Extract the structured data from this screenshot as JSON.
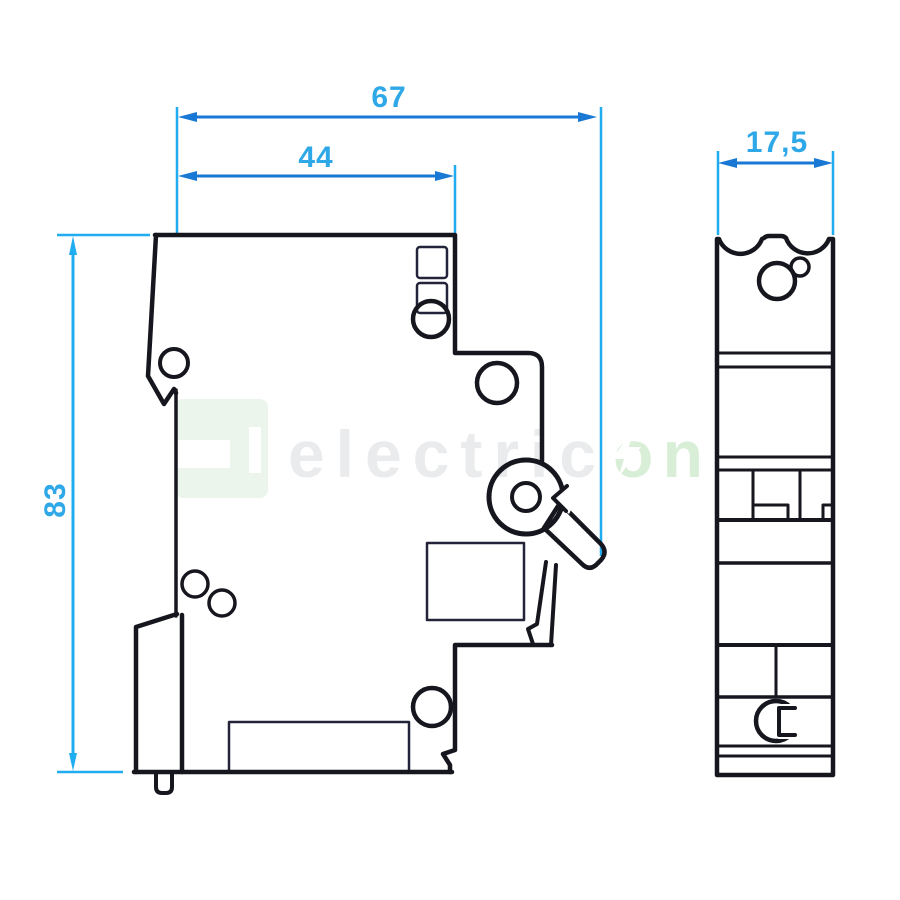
{
  "drawing": {
    "dimensions": {
      "total_depth": "67",
      "case_depth": "44",
      "module_width": "17,5",
      "height": "83"
    },
    "watermark": {
      "word_gray": "electric",
      "word_green": "on",
      "logo": "electricon-logo",
      "bolt": "lightning-bolt-icon"
    },
    "colors": {
      "dimension_line": "#1878d4",
      "extension_line": "#1fadf0",
      "dimension_text": "#2fa8e8",
      "outline": "#16161e",
      "watermark_gray": "#e9ebec",
      "watermark_green": "#d8eed6",
      "background": "#ffffff"
    }
  }
}
